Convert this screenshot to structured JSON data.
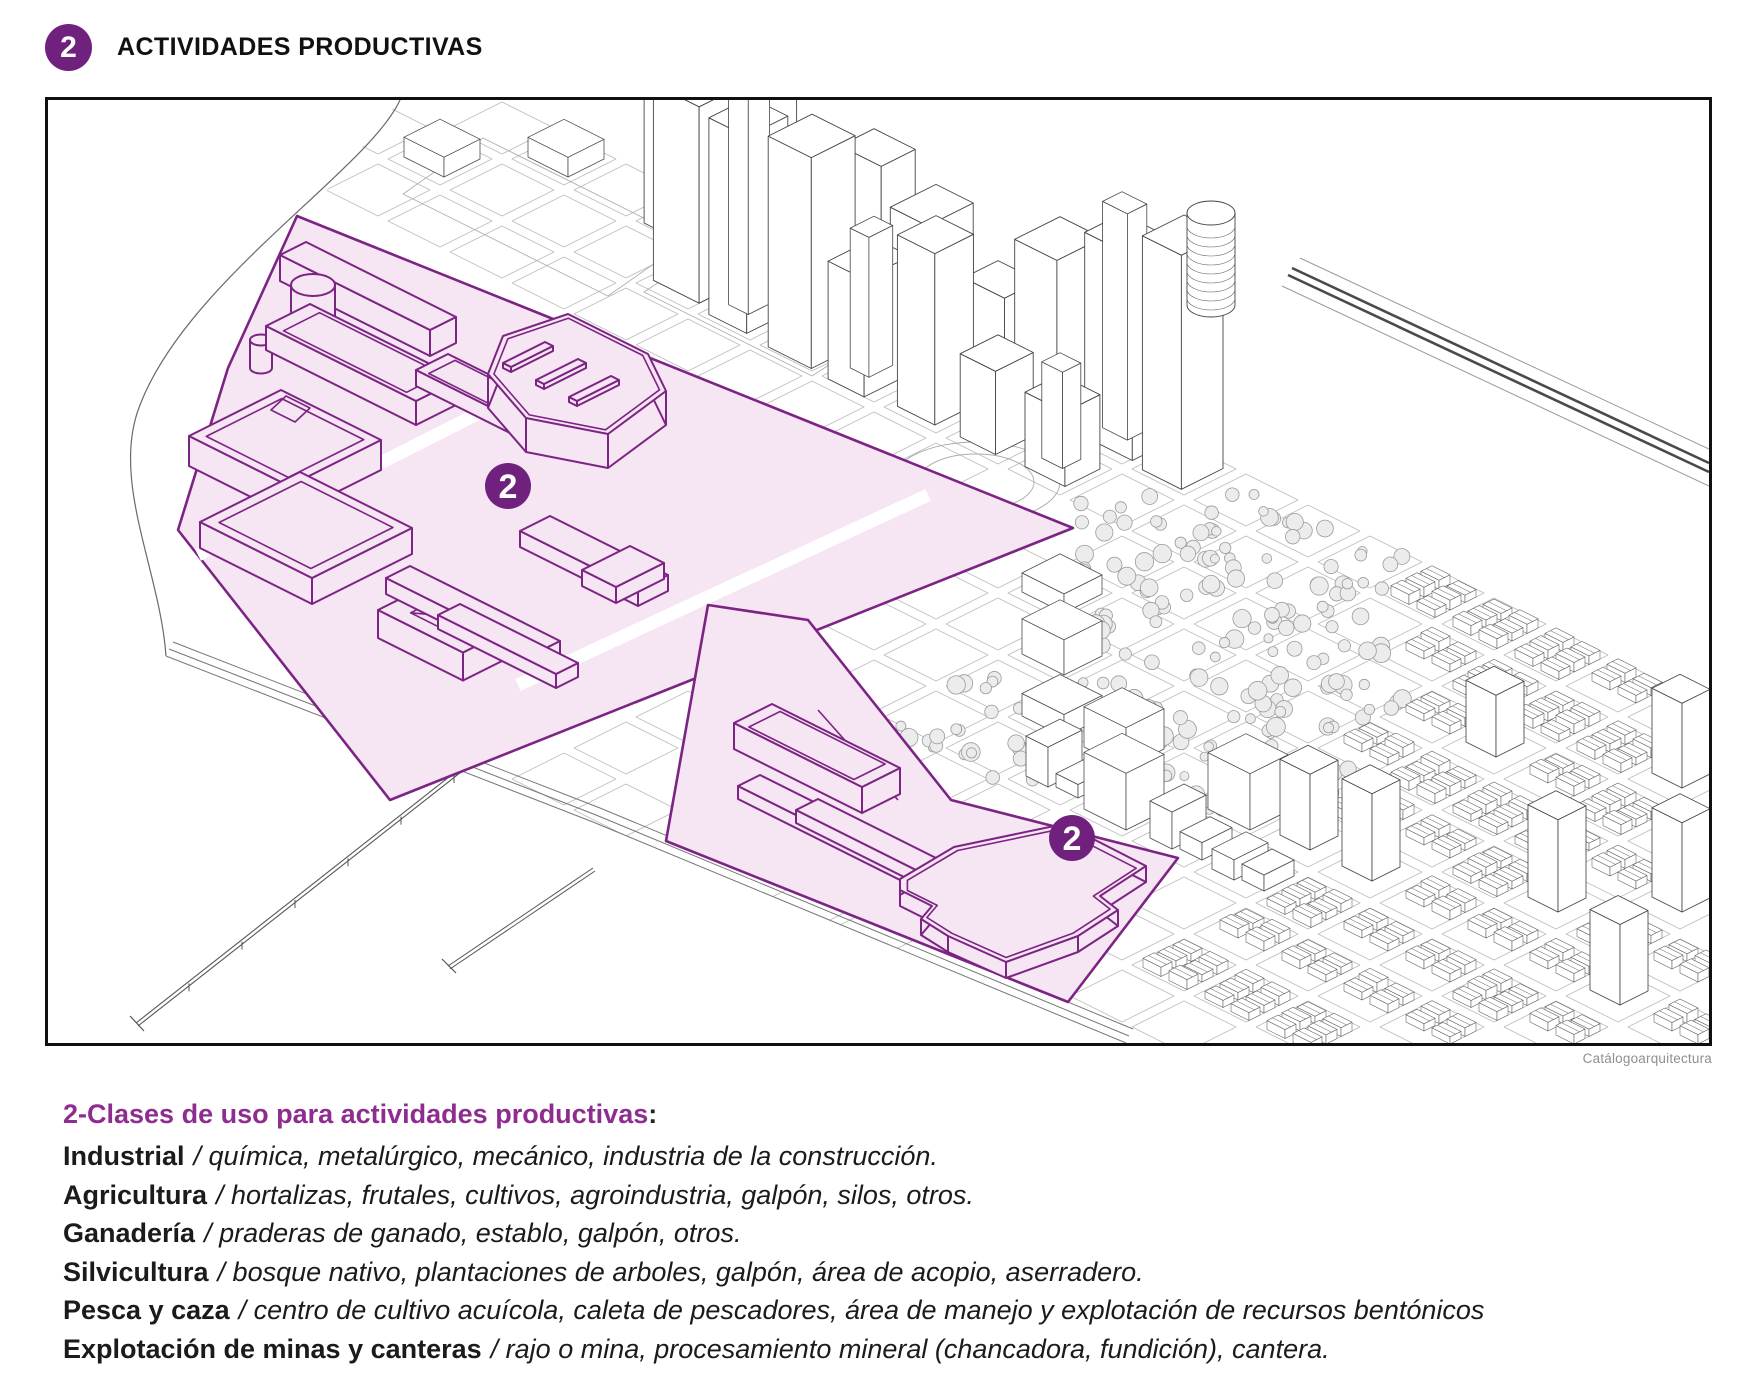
{
  "header": {
    "badge": "2",
    "title": "ACTIVIDADES PRODUCTIVAS"
  },
  "map": {
    "zone_badge": "2",
    "caption": "Catálogoarquitectura"
  },
  "colors": {
    "purple": "#7c2483",
    "zone_fill": "#f6e5f3",
    "badge_fill": "#70217e",
    "heading_purple": "#8e2c8f",
    "line_art": "#474747",
    "text": "#1b1b1b",
    "caption_gray": "#8f8f8f"
  },
  "legend": {
    "heading": "2-Clases de uso para actividades productivas",
    "heading_colon": ":",
    "items": [
      {
        "term": "Industrial",
        "desc": "/ química, metalúrgico, mecánico, industria de la construcción."
      },
      {
        "term": "Agricultura",
        "desc": "/ hortalizas, frutales, cultivos, agroindustria, galpón, silos, otros."
      },
      {
        "term": "Ganadería",
        "desc": "/ praderas de ganado, establo, galpón, otros."
      },
      {
        "term": "Silvicultura",
        "desc": "/ bosque nativo, plantaciones de arboles, galpón, área de acopio, aserradero."
      },
      {
        "term": "Pesca y caza",
        "desc": "/ centro de cultivo acuícola, caleta de pescadores, área de manejo y explotación de recursos bentónicos"
      },
      {
        "term": "Explotación de minas y canteras",
        "desc": "/ rajo o mina, procesamiento mineral (chancadora, fundición), cantera."
      }
    ]
  }
}
